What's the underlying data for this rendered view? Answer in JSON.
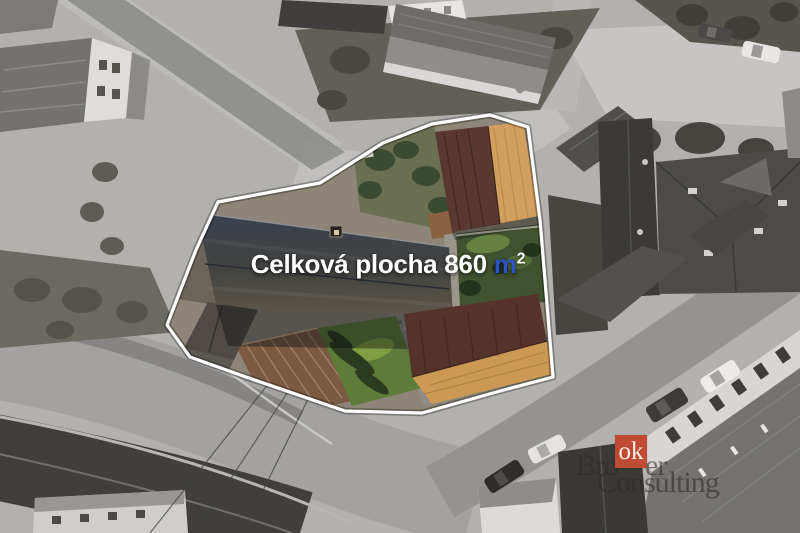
{
  "photo": {
    "description_label": "aerial-property-photo",
    "overlay": {
      "area_label": "Celková plocha 860",
      "area_unit": "m",
      "area_exponent": "2",
      "label_color": "#ffffff",
      "unit_color": "#2d52c8"
    },
    "property": {
      "total_area_m2": 860,
      "outline_color": "#ffffff"
    },
    "watermark": {
      "line1_left": "Bro",
      "box_text": "ok",
      "line1_right": "er",
      "line2": "Consulting",
      "box_color": "#c04b34"
    }
  }
}
